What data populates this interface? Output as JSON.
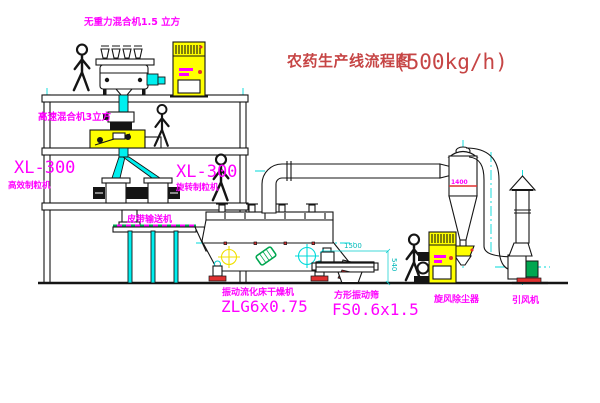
{
  "title": {
    "main": "农药生产线流程图",
    "capacity": "(500kg/h)"
  },
  "labels": {
    "gravity_mixer": "无重力混合机1.5 立方",
    "high_speed_mixer": "高速混合机3立方",
    "granulator_left_model": "XL-300",
    "granulator_left_name": "高效制粒机",
    "granulator_right_model": "XL-300",
    "granulator_right_name": "旋转制粒机",
    "belt_conveyor": "皮带输送机",
    "dryer_name": "振动流化床干燥机",
    "dryer_model": "ZLG6x0.75",
    "sieve_name": "方形振动筛",
    "sieve_model": "FS0.6x1.5",
    "cyclone": "旋风除尘器",
    "fan": "引风机"
  },
  "dimensions": {
    "sieve_length": "1500",
    "sieve_height": "540",
    "cyclone_body": "1400"
  },
  "colors": {
    "label_magenta": "#ff00ff",
    "title_red": "#c64545",
    "accent_red": "#e03030",
    "pipe_cyan": "#00efef",
    "centerline_cyan": "#00dada",
    "cabinet_yellow": "#ffff00",
    "motor_green": "#00a650",
    "line_black": "#151515"
  }
}
